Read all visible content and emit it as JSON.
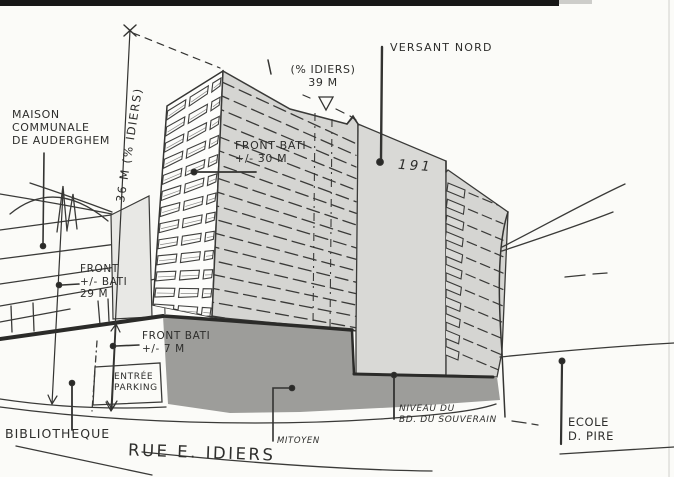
{
  "document": {
    "type": "architectural-sketch",
    "subject": "building massing study at Rue E. Idiers / Auderghem"
  },
  "labels": {
    "maison_communale": "MAISON\nCOMMUNALE\nDE AUDERGHEM",
    "dim_36m": "36 M (% IDIERS)",
    "level_39m": "(% IDIERS)\n39 M",
    "versant_nord": "VERSANT NORD",
    "front_bati_30m": "FRONT BATI\n+/- 30 M",
    "building_number": "191",
    "front_bati_29m": "FRONT\n+/- BATI\n29 M",
    "front_bati_7m": "FRONT BATI\n+/- 7 M",
    "entree_parking": "ENTRÉE\nPARKING",
    "bibliotheque": "BIBLIOTHEQUE",
    "rue": "RUE E. IDIERS",
    "mitoyen": "MITOYEN",
    "niveau": "NIVEAU DU\nBD. DU SOUVERAIN",
    "ecole": "ECOLE\nD. PIRE"
  },
  "icons": {
    "level_marker": "triangle-down-level-icon",
    "dimension_top": "x-tick-icon",
    "dimension_arrows": "arrowhead-icon",
    "leader_dot": "dot-icon"
  },
  "colors": {
    "paper": "#fbfbf8",
    "ink": "#38383a",
    "tower_face_hatched": "#d5d5d2",
    "tower_face_smooth": "#d9d9d6",
    "party_wall_dark": "#9d9d9a",
    "stair_strip": "#e8e8e5",
    "scan_edge_black": "#171717"
  }
}
